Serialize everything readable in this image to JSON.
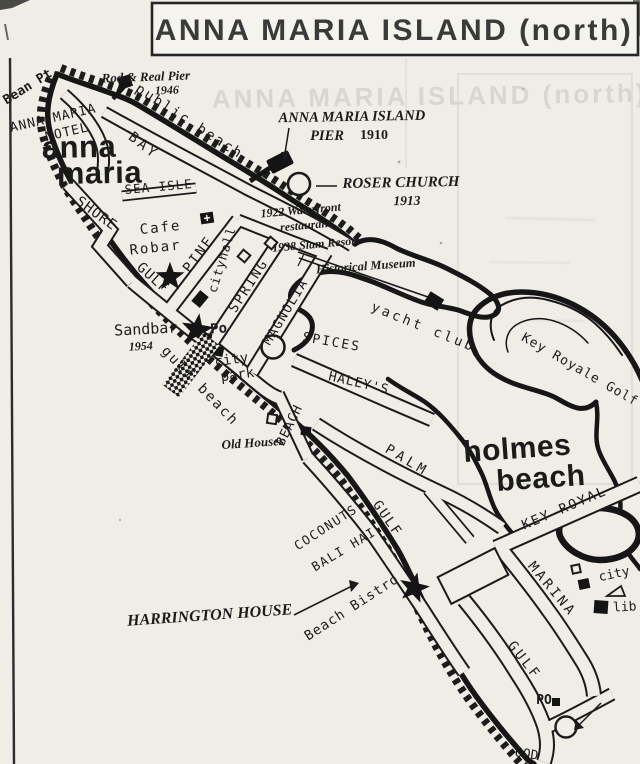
{
  "labels": {
    "title": "ANNA MARIA ISLAND (north)",
    "ghost_title": "ANNA MARIA ISLAND (north)",
    "bean_pt": "Bean Pt.",
    "rod_reel_pier": "Rod & Real Pier",
    "rod_reel_year": "1946",
    "public_beach": "public beach",
    "motel_line1": "ANNA MARIA",
    "motel_line2": "MOTEL",
    "town_anna_line1": "anna",
    "town_anna_line2": "maria",
    "bay": "BAY",
    "sea_isle": "SEA ISLE",
    "ami_pier_line1": "ANNA MARIA ISLAND",
    "ami_pier_line2": "PIER",
    "ami_pier_year": "1910",
    "roser_church": "ROSER CHURCH",
    "roser_year": "1913",
    "waterfront_line1": "1922 Waterfront",
    "waterfront_line2": "restaurant",
    "slam_resort": "1938 Slam Resort",
    "museum": "Historical Museum",
    "cafe_line1": "Cafe",
    "cafe_line2": "Robar",
    "shore": "SHORE",
    "gulf_anna": "GULF",
    "pine": "PINE",
    "cityhall": "cityhall",
    "spring": "SPRING",
    "magnolia": "MAGNOLIA",
    "yacht_club": "yacht club",
    "key_royale_golf": "Key Royale Golf",
    "spices": "SPICES",
    "haleys": "HALEY'S",
    "sandbar": "Sandbar",
    "sandbar_year": "1954",
    "po_anna": "Po",
    "city_park_line1": "city",
    "city_park_line2": "park",
    "gulf_beach": "gulf beach",
    "beach_street": "BEACH",
    "old_houses": "Old Houses",
    "palm": "PALM",
    "town_holmes_line1": "holmes",
    "town_holmes_line2": "beach",
    "key_royal": "KEY ROYAL",
    "gulf_mid": "GULF",
    "coconuts": "COCONUTS",
    "bali_hai": "BALI HAI",
    "harrington_house": "HARRINGTON HOUSE",
    "beach_bistro": "Beach Bistro",
    "marina": "MARINA",
    "gulf_south": "GULF",
    "city_holmes": "city",
    "library": "lib",
    "po_holmes": "PO",
    "partial_word": "OOD"
  },
  "colors": {
    "paper": "#efede6",
    "ink": "#1b1b1b",
    "ghost": "#d8d7cf"
  }
}
